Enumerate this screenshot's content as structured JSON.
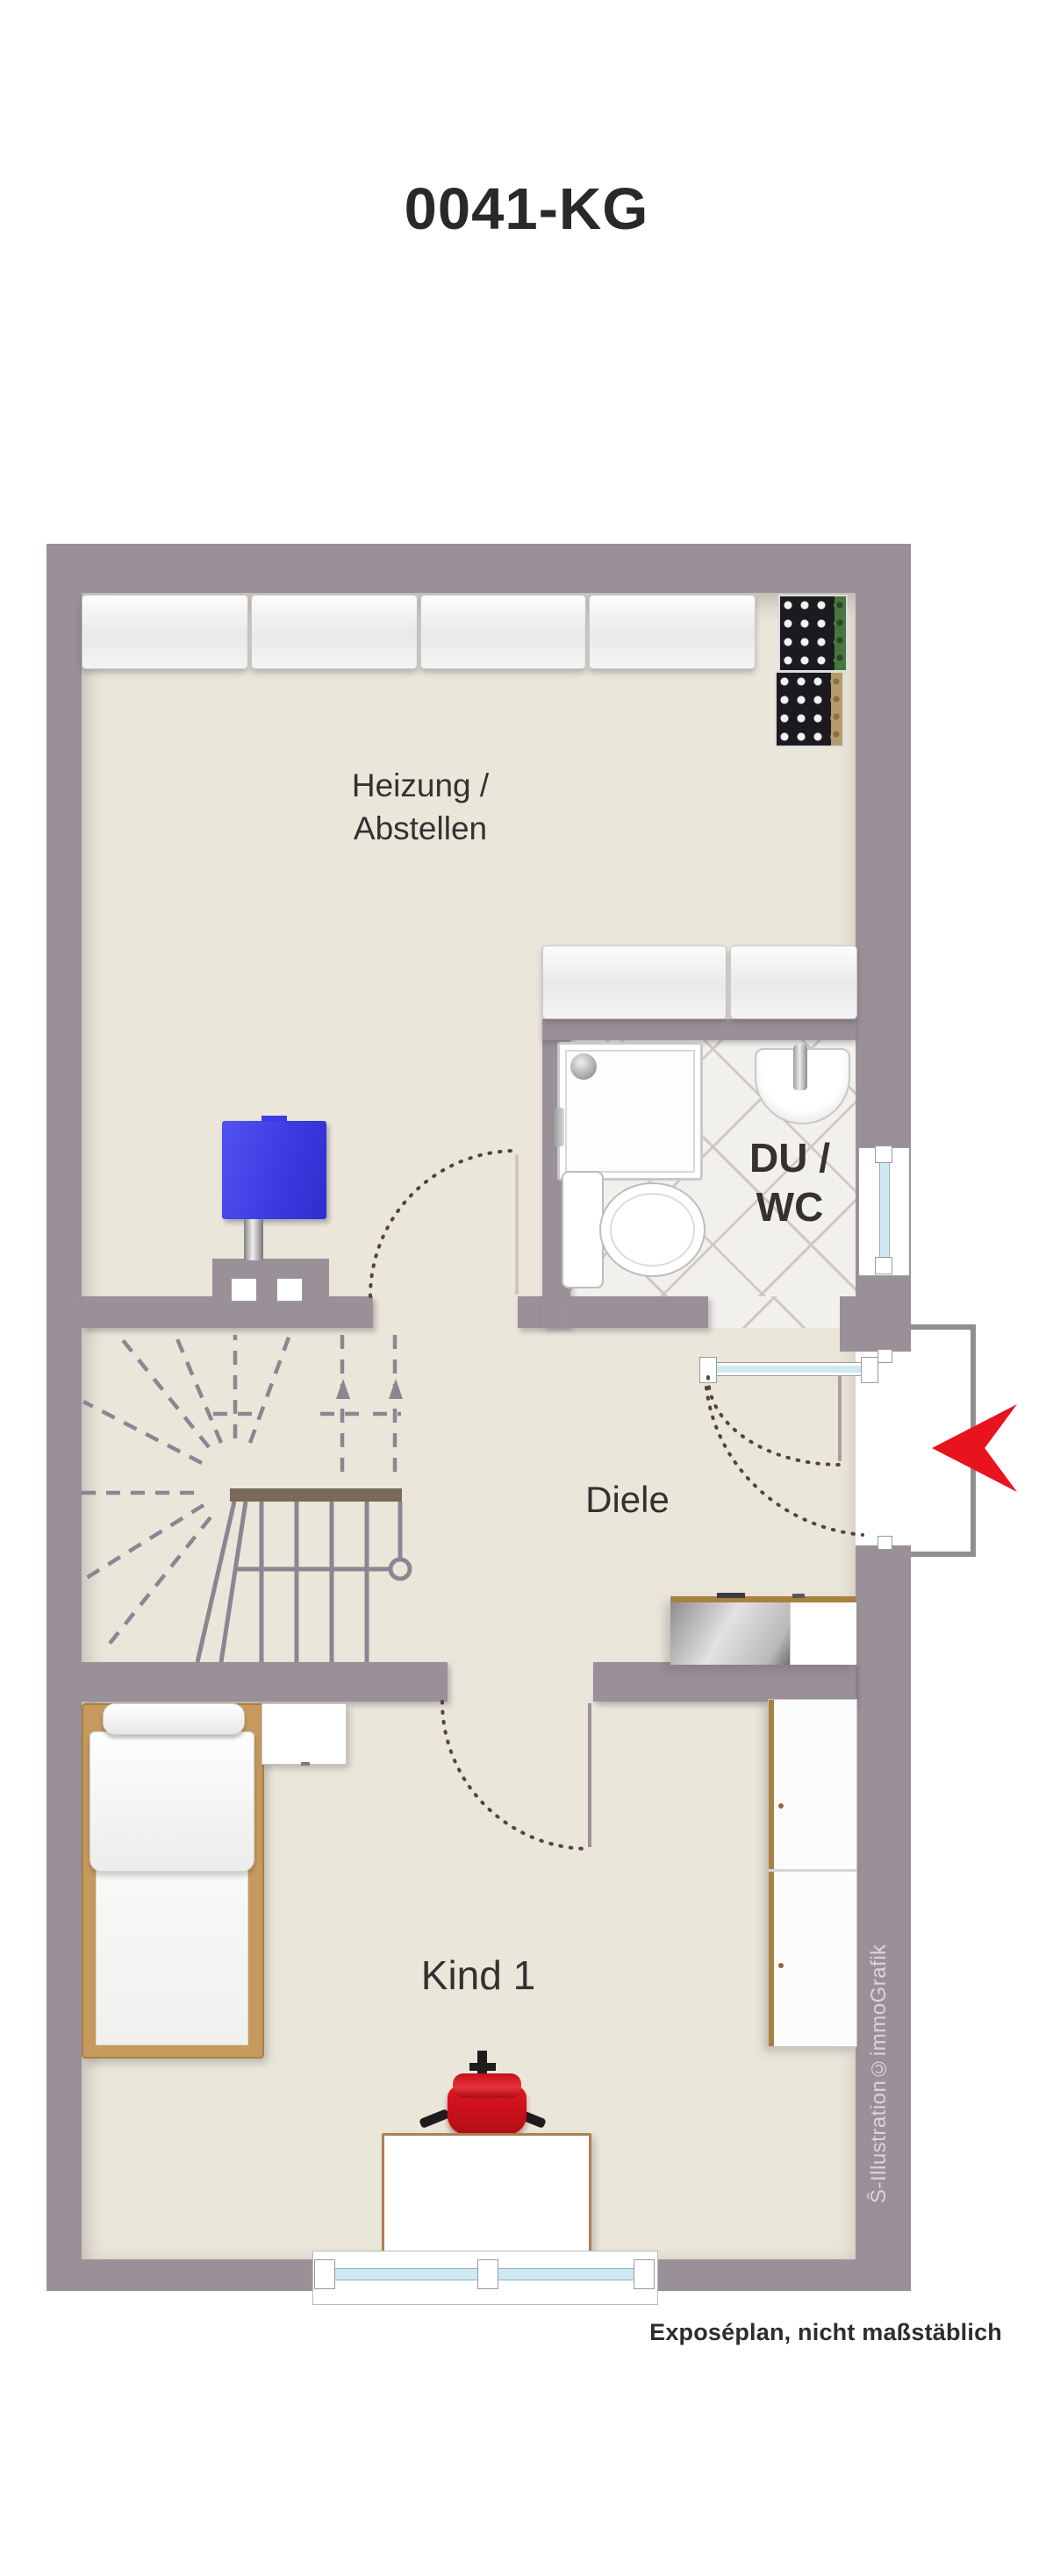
{
  "title": "0041-KG",
  "plan": {
    "rooms": {
      "heizung": {
        "line1": "Heizung /",
        "line2": "Abstellen"
      },
      "du_wc": {
        "line1": "DU /",
        "line2": "WC"
      },
      "diele": {
        "label": "Diele"
      },
      "kind1": {
        "label": "Kind 1"
      }
    }
  },
  "annotations": {
    "footer_note": "Exposéplan, nicht maßstäblich",
    "credit_vertical": "Ŝ-Illustration©immoGrafik"
  },
  "colors": {
    "wall": "#9a9098",
    "floor": "#eae6da",
    "tile_line": "#cfc9c3",
    "entrance_arrow_red": "#e8131c",
    "chair_red": "#d8111b",
    "boiler_blue": "#3c3ce4",
    "wood": "#c69a5e",
    "window_glass": "#cfe9f3"
  }
}
